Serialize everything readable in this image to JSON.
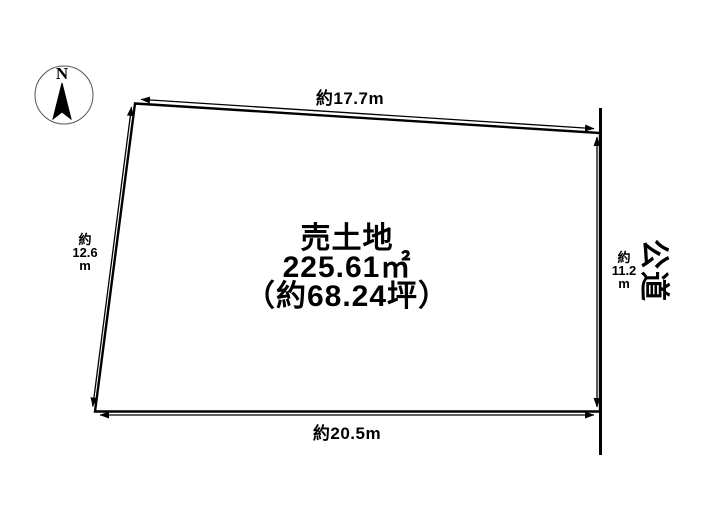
{
  "compass": {
    "north": "N"
  },
  "plot": {
    "name": "売土地",
    "area_m2": "225.61㎡",
    "area_tsubo": "（約68.24坪）"
  },
  "dimensions": {
    "top": "約17.7m",
    "bottom": "約20.5m",
    "left": "約\n12.6\nm",
    "right": "約\n11.2\nm"
  },
  "road": {
    "label": "公道"
  },
  "colors": {
    "line": "#000000",
    "background": "#ffffff"
  }
}
